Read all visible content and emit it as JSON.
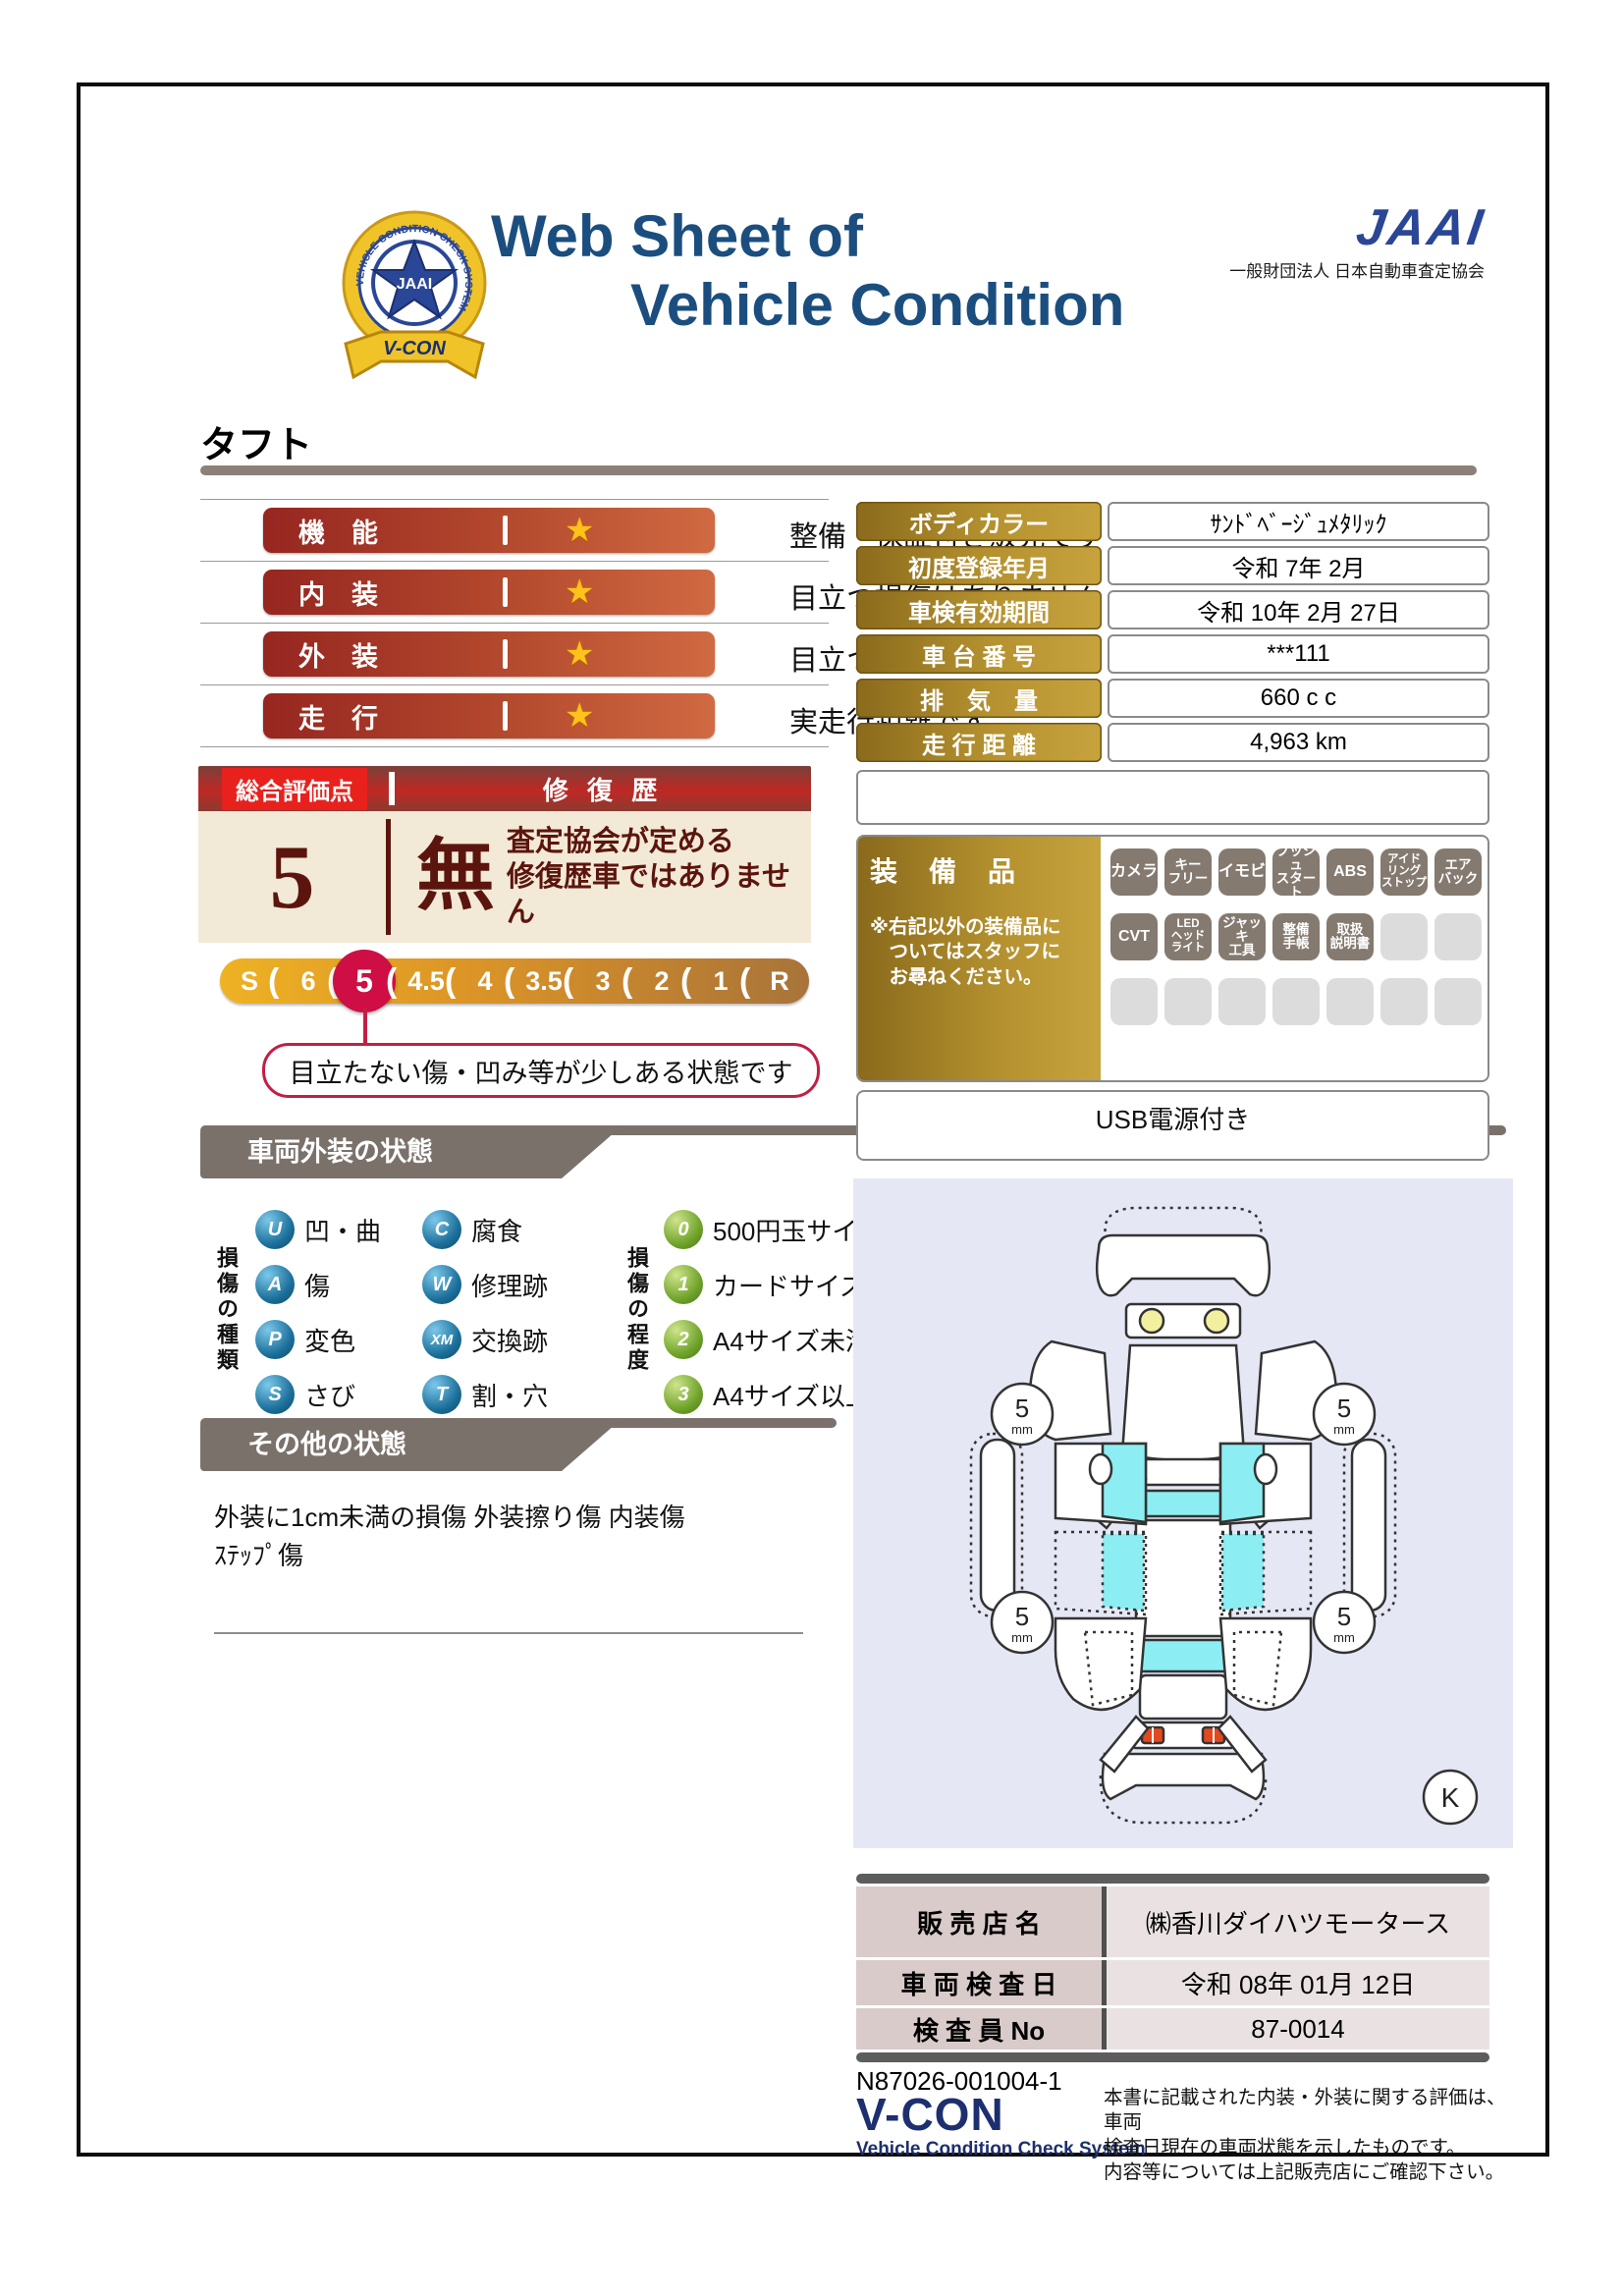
{
  "header": {
    "title_line1": "Web Sheet of",
    "title_line2": "Vehicle Condition",
    "jaai_logo": "JAAI",
    "jaai_subtitle": "一般財団法人 日本自動車査定協会",
    "emblem": {
      "center": "JAAI",
      "ring_text": "VEHICLE CONDITION CHECK SYSTEM",
      "ribbon": "V-CON"
    }
  },
  "vehicle_name": "タフト",
  "ratings": [
    {
      "label": "機　能",
      "desc": "整備・保証付き販売です"
    },
    {
      "label": "内　装",
      "desc": "目立つ損傷はありません"
    },
    {
      "label": "外　装",
      "desc": "目立つ損傷はありません"
    },
    {
      "label": "走　行",
      "desc": "実走行距離です"
    }
  ],
  "summary": {
    "score_label": "総合評価点",
    "score": "5",
    "repair_label": "修 復 歴",
    "repair_value": "無",
    "repair_desc1": "査定協会が定める",
    "repair_desc2": "修復歴車ではありません"
  },
  "scale": {
    "items": [
      "S",
      "6",
      "5",
      "4.5",
      "4",
      "3.5",
      "3",
      "2",
      "1",
      "R"
    ],
    "selected": "5",
    "callout": "目立たない傷・凹み等が少しある状態です"
  },
  "info_table": {
    "rows": [
      {
        "label": "ボディカラー",
        "value": "ｻﾝﾄﾞﾍﾞｰｼﾞｭﾒﾀﾘｯｸ"
      },
      {
        "label": "初度登録年月",
        "value": "令和 7年 2月"
      },
      {
        "label": "車検有効期間",
        "value": "令和 10年 2月 27日"
      },
      {
        "label": "車 台 番 号",
        "value": "***111"
      },
      {
        "label": "排　気　量",
        "value": "660 c c"
      },
      {
        "label": "走 行 距 離",
        "value": "4,963 km"
      }
    ]
  },
  "equipment": {
    "title": "装　備　品",
    "note1": "※右記以外の装備品に",
    "note2": "　ついてはスタッフに",
    "note3": "　お尋ねください。",
    "badges": [
      "カメラ",
      "キー\nフリー",
      "イモビ",
      "プッシュ\nスタート",
      "ABS",
      "アイド\nリング\nストップ",
      "エア\nバック",
      "CVT",
      "LED\nヘッド\nライト",
      "ジャッキ\n工具",
      "整備\n手帳",
      "取扱\n説明書"
    ],
    "usb_note": "USB電源付き"
  },
  "exterior": {
    "header": "車両外装の状態",
    "type_label": "損傷の種類",
    "types": [
      {
        "code": "U",
        "label": "凹・曲"
      },
      {
        "code": "A",
        "label": "傷"
      },
      {
        "code": "P",
        "label": "変色"
      },
      {
        "code": "S",
        "label": "さび"
      },
      {
        "code": "C",
        "label": "腐食"
      },
      {
        "code": "W",
        "label": "修理跡"
      },
      {
        "code": "XM",
        "label": "交換跡"
      },
      {
        "code": "T",
        "label": "割・穴"
      }
    ],
    "degree_label": "損傷の程度",
    "degrees": [
      {
        "code": "0",
        "label": "500円玉サイズ未満"
      },
      {
        "code": "1",
        "label": "カードサイズ未満"
      },
      {
        "code": "2",
        "label": "A4サイズ未満"
      },
      {
        "code": "3",
        "label": "A4サイズ以上"
      }
    ]
  },
  "other_condition": {
    "header": "その他の状態",
    "line1": "外装に1cm未満の損傷 外装擦り傷 内装傷",
    "line2": "ｽﾃｯﾌﾟ傷"
  },
  "diagram": {
    "tire_value": "5",
    "tire_unit": "mm",
    "key_mark": "K"
  },
  "dealer": {
    "rows": [
      {
        "label": "販 売 店 名",
        "value": "㈱香川ダイハツモータース"
      },
      {
        "label": "車 両 検 査 日",
        "value": "令和 08年 01月 12日"
      },
      {
        "label": "検 査 員 No",
        "value": "87-0014"
      }
    ]
  },
  "footer": {
    "serial": "N87026-001004-1",
    "vcon_logo": "V-CON",
    "vcon_sub": "Vehicle Condition Check System",
    "disclaimer1": "本書に記載された内装・外装に関する評価は、車両",
    "disclaimer2": "検査日現在の車両状態を示したものです。",
    "disclaimer3": "内容等については上記販売店にご確認下さい。"
  },
  "colors": {
    "title_navy": "#1b4e7e",
    "jaai_blue": "#2a4696",
    "pill_red": "#962620",
    "gold": "#8a6a1c",
    "cream": "#f2ead6",
    "maroon": "#5c150e",
    "selected_circle": "#ce0e44",
    "tab_gray": "#7b716b",
    "window_cyan": "#8ceef2",
    "panel_lavender": "#e5e8f4"
  }
}
